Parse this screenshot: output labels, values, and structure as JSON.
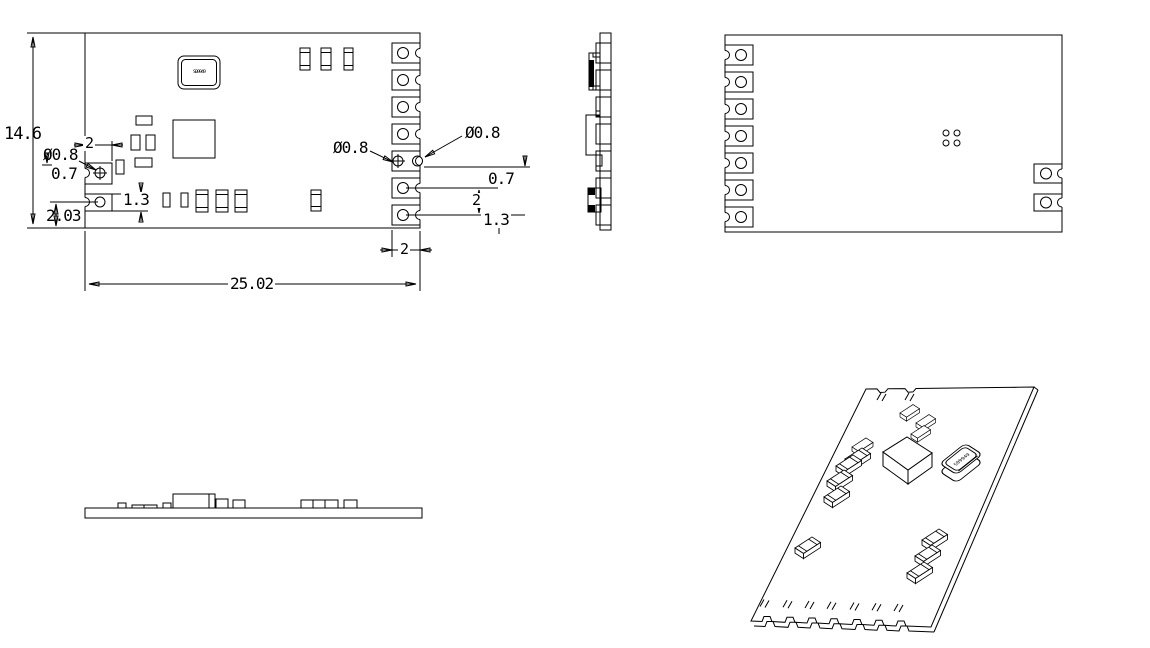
{
  "colors": {
    "background": "#ffffff",
    "line": "#000000"
  },
  "dimensions": {
    "board_height": "14.6",
    "board_width": "25.02",
    "left": {
      "pad_width": "2",
      "hole_dia": "Ø0.8",
      "hole_offset": "0.7",
      "pad_edge_offset": "2.03",
      "pad_height": "1.3"
    },
    "right": {
      "hole_dia_inner": "Ø0.8",
      "hole_dia_edge": "Ø0.8",
      "pad_gap": "0.7",
      "pad_pitch": "2",
      "pad_height": "1.3",
      "pad_width": "2"
    }
  },
  "components": {
    "crystal_marking": "S09949"
  }
}
